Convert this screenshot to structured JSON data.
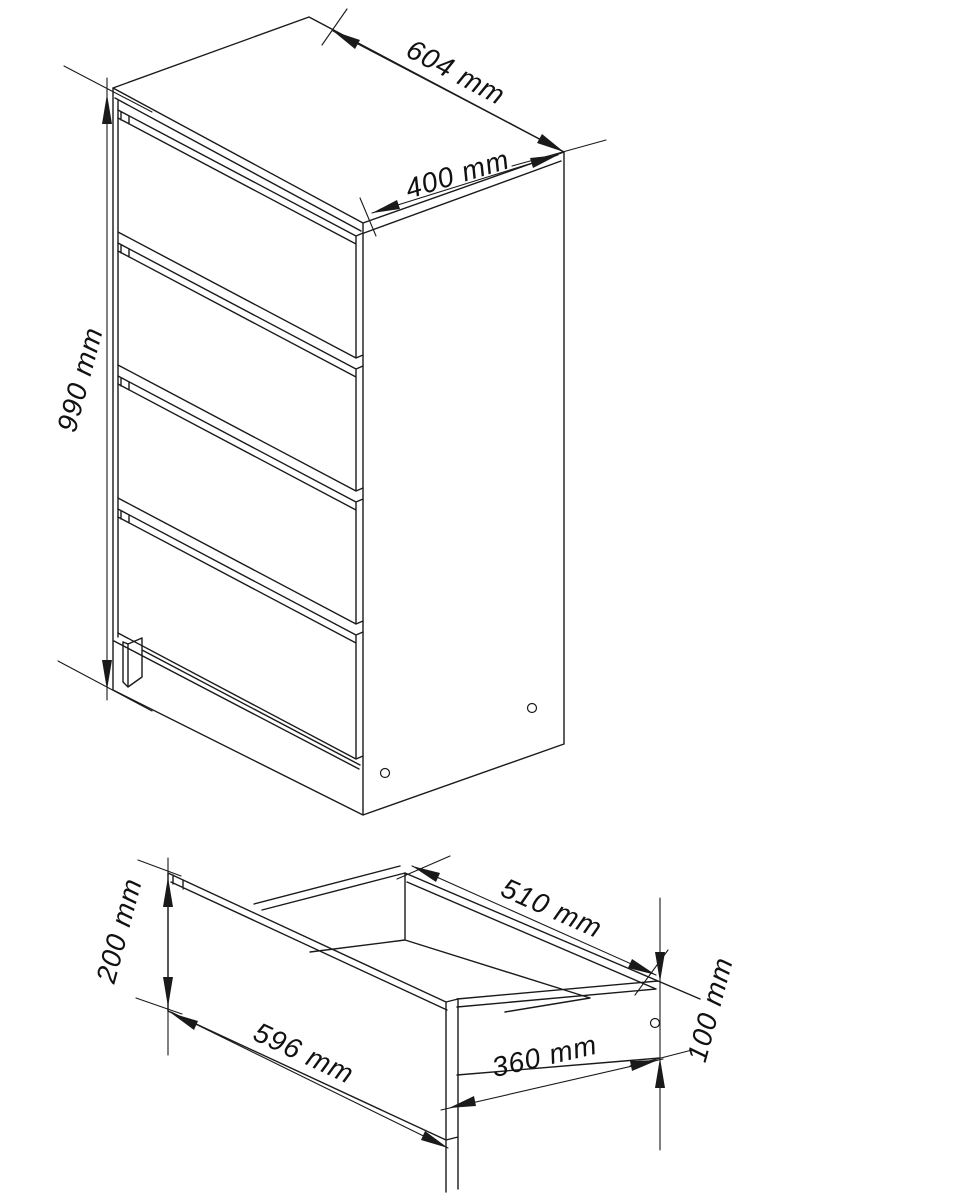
{
  "drawing": {
    "views": {
      "cabinet": {
        "description": "isometric chest of drawers",
        "drawer_count": 4,
        "dims": {
          "width": "604 mm",
          "depth": "400 mm",
          "height": "990 mm"
        }
      },
      "drawer": {
        "description": "isometric single drawer box",
        "dims": {
          "front_width": "596 mm",
          "front_height": "200 mm",
          "box_rear_width": "510 mm",
          "box_side_depth": "360 mm",
          "box_side_height": "100 mm"
        }
      }
    },
    "colors": {
      "line": "#1a1a1a",
      "background": "#ffffff"
    }
  }
}
